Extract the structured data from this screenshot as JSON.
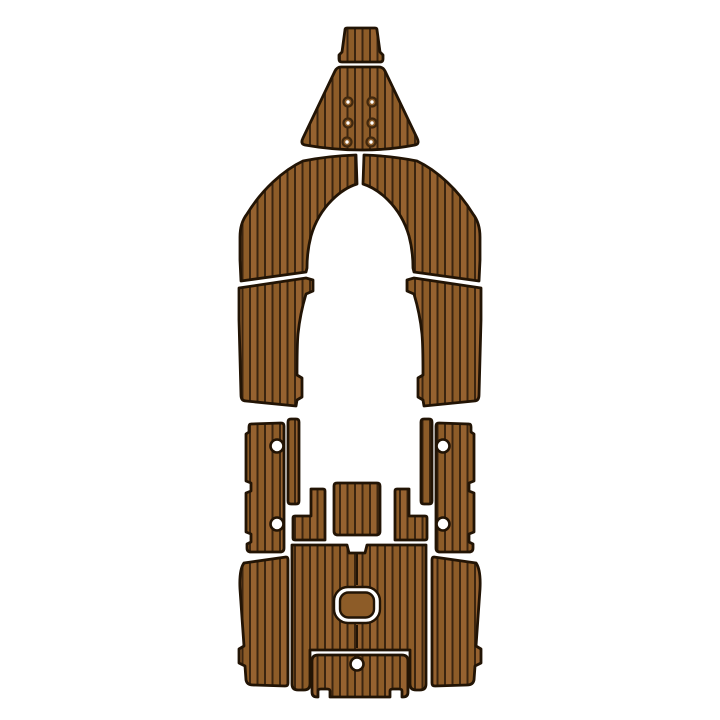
{
  "meta": {
    "type": "product-photo",
    "subject": "EVA foam faux-teak boat decking pad set, top view on white background",
    "background": "#ffffff"
  },
  "palette": {
    "plank": "#8d5c28",
    "plank_alt": "#966230",
    "stripe": "#3b2510",
    "outline": "#221405",
    "hole_fill": "#ffffff",
    "fastener_ring": "#41280e",
    "fastener_dot": "#ffffff"
  },
  "stripes": {
    "spacing": 7.5,
    "line_width": 2
  },
  "pieces": [
    {
      "id": "bow-tip-pad",
      "path": "M347,28 L375,28 Q377,28 377,30 L380,52 L383,55 L383,59 Q383,62 380,62 L342,62 Q339,62 339,59 L339,55 L342,52 L345,30 Q345,28 347,28 Z"
    },
    {
      "id": "bow-pad",
      "path": "M341,67 L379,67 Q383,67 385,71 L417,138 Q420,144 415,145 Q389,150 362,150 Q333,150 305,145 Q300,144 303,138 L335,71 Q337,67 341,67 Z"
    },
    {
      "id": "bow-walkaround-left",
      "path": "M356,155 L357,184 Q344,188 332,200 Q317,215 311,236 Q307,251 307,268 L306,272 L241,281 L240,260 L240,237 Q240,223 247,214 Q258,196 273,182 Q288,168 303,161 Q328,156 356,155 Z"
    },
    {
      "id": "bow-walkaround-right",
      "path": "M364,155 L363,184 Q376,188 388,200 Q403,215 409,236 Q413,251 413,268 L414,272 L479,281 L480,260 L480,237 Q480,223 473,214 Q462,196 447,182 Q432,168 417,161 Q392,156 364,155 Z"
    },
    {
      "id": "side-step-left",
      "path": "M239,288 L306,278 L313,280 L313,291 L306,294 Q300,314 298,334 Q297,345 297,375 L302,378 L302,397 L297,400 L296,406 L246,401 Q241,401 241,395 L239,320 Z"
    },
    {
      "id": "side-step-right",
      "path": "M481,288 L414,278 L407,280 L407,291 L414,294 Q420,314 422,334 Q423,345 423,375 L418,378 L418,397 L423,400 L424,406 L474,401 Q479,401 479,395 L481,320 Z"
    },
    {
      "id": "gunwale-pad-left",
      "path": "M251,424 L281,423 Q284,423 284,426 L284,548 Q284,552 280,552 L251,552 Q247,552 247,548 L247,544 L251,542 L251,534 L246,532 L246,493 L251,491 L251,483 L246,481 L246,434 L249,432 L249,427 Q249,424 251,424 Z"
    },
    {
      "id": "gunwale-strip-left",
      "path": "M291,419 L296,419 Q299,419 299,422 L299,501 Q299,504 296,504 L291,504 Q288,504 288,501 L288,422 Q288,419 291,419 Z"
    },
    {
      "id": "gunwale-pad-right",
      "path": "M469,424 L439,423 Q436,423 436,426 L436,548 Q436,552 440,552 L469,552 Q473,552 473,548 L473,544 L469,542 L469,534 L474,532 L474,493 L469,491 L469,483 L474,481 L474,434 L471,432 L471,427 Q471,424 469,424 Z"
    },
    {
      "id": "gunwale-strip-right",
      "path": "M429,419 L424,419 Q421,419 421,422 L421,501 Q421,504 424,504 L429,504 Q432,504 432,501 L432,422 Q432,419 429,419 Z"
    },
    {
      "id": "console-step-pad",
      "path": "M337,483 L377,483 Q380,483 380,486 L380,531 Q380,535 376,535 L338,535 Q334,535 334,531 L334,486 Q334,483 337,483 Z"
    },
    {
      "id": "arm-pad-left",
      "path": "M311,489 L323,489 Q325,489 325,491 L325,540 L295,540 Q293,540 293,538 L293,518 Q293,516 295,516 L311,516 Z"
    },
    {
      "id": "arm-pad-right",
      "path": "M409,489 L397,489 Q395,489 395,491 L395,540 L425,540 Q427,540 427,538 L427,518 Q427,516 425,516 L409,516 Z"
    },
    {
      "id": "cockpit-floor-pad",
      "path": "M292,545 L347,545 L349,553 L365,553 L367,545 L426,545 L426,684 Q426,690 420,690 L416,690 Q410,690 410,684 L410,650 L310,650 L310,684 Q310,690 304,690 L298,690 Q292,690 292,684 Z"
    },
    {
      "id": "transom-pad",
      "path": "M318,655 L402,655 Q408,655 408,661 L408,692 Q408,697 403,697 L402,697 L402,691 Q402,689 399,689 L393,689 Q390,689 390,691 L390,697 L330,697 L330,691 Q330,689 327,689 L321,689 Q318,689 318,691 L318,697 L317,697 Q312,697 312,692 L312,661 Q312,655 318,655 Z"
    },
    {
      "id": "floor-wing-left",
      "path": "M244,563 L286,557 Q288,557 288,560 L288,683 Q288,686 285,686 L253,685 Q247,685 246,680 L245,666 L239,663 L239,649 L244,646 L240,589 Q239,570 244,563 Z"
    },
    {
      "id": "floor-wing-right",
      "path": "M476,563 L434,557 Q432,557 432,560 L432,683 Q432,686 435,686 L467,685 Q473,685 474,680 L475,666 L481,663 L481,649 L476,646 L480,589 Q481,570 476,563 Z"
    }
  ],
  "hatch": {
    "outer": {
      "x": 334,
      "y": 587,
      "w": 46,
      "h": 36,
      "rx": 14
    },
    "inner": {
      "x": 340,
      "y": 592.5,
      "w": 34,
      "h": 25,
      "rx": 8.5
    }
  },
  "seams": [
    {
      "x1": 357,
      "y1": 554,
      "x2": 357,
      "y2": 585
    },
    {
      "x1": 357,
      "y1": 625,
      "x2": 357,
      "y2": 648
    }
  ],
  "fasteners": {
    "outer_r": 5.6,
    "mid_r": 3.4,
    "dot_r": 1.7,
    "positions": [
      [
        348,
        102
      ],
      [
        372,
        102
      ],
      [
        348,
        123
      ],
      [
        372,
        123
      ],
      [
        347,
        142
      ],
      [
        371,
        142
      ]
    ]
  },
  "holes": [
    {
      "cx": 277,
      "cy": 446,
      "r": 6.5
    },
    {
      "cx": 277,
      "cy": 524,
      "r": 6.5
    },
    {
      "cx": 443,
      "cy": 446,
      "r": 6.5
    },
    {
      "cx": 443,
      "cy": 524,
      "r": 6.5
    },
    {
      "cx": 357,
      "cy": 664,
      "r": 6.5
    }
  ]
}
